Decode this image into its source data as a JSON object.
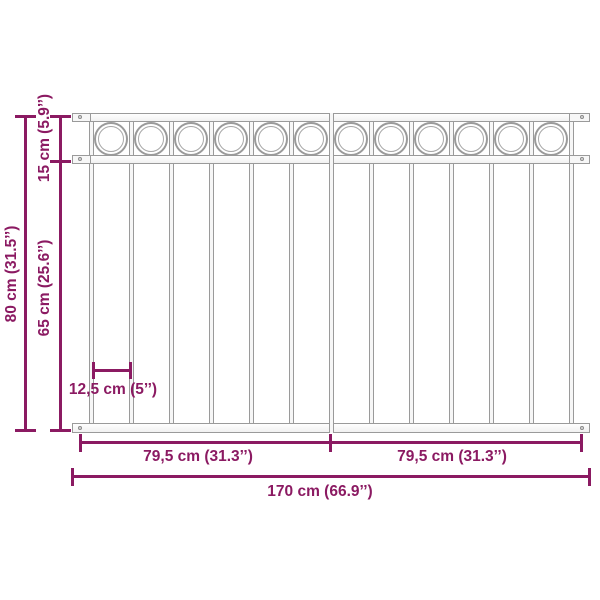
{
  "diagram": {
    "title": "fence-panel-dimension-diagram",
    "accent_color": "#8b1a62",
    "fence_line_color": "#9a9a9a",
    "background_color": "#ffffff"
  },
  "dimensions": {
    "total_height": "80 cm (31.5’’)",
    "top_section_height": "15 cm (5.9’’)",
    "lower_section_height": "65 cm (25.6’’)",
    "bar_spacing": "12,5 cm (5’’)",
    "half_width_left": "79,5 cm (31.3’’)",
    "half_width_right": "79,5 cm (31.3’’)",
    "total_width": "170 cm (66.9’’)"
  },
  "fence": {
    "num_circles": 12,
    "num_bars": 13
  }
}
